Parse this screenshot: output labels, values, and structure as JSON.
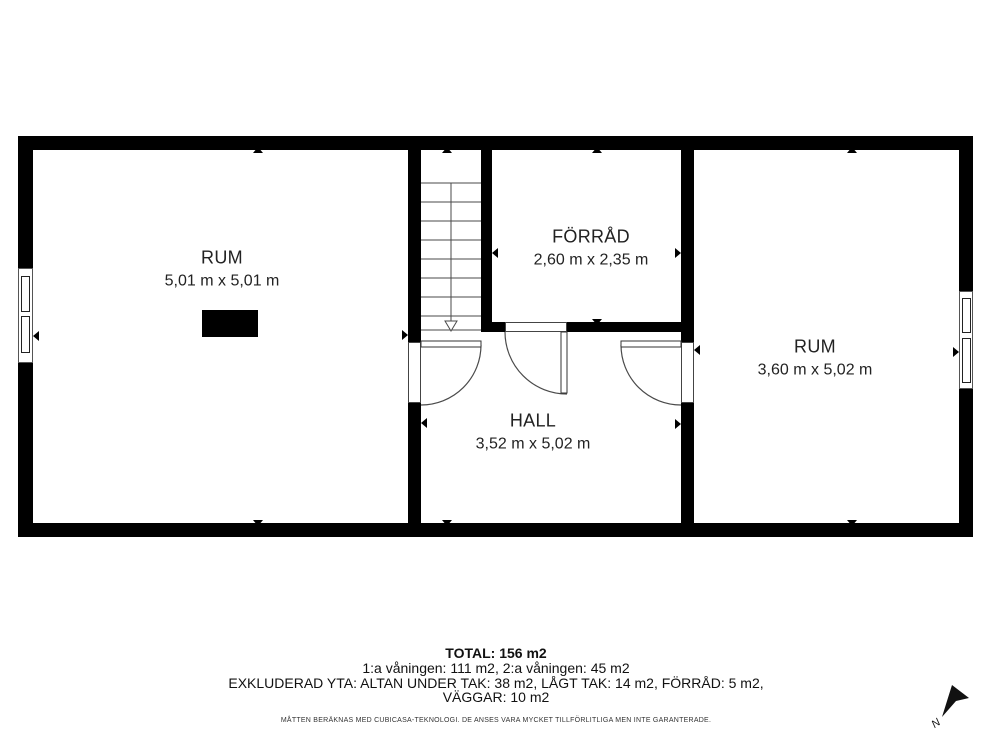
{
  "floorplan": {
    "rooms": [
      {
        "name": "RUM",
        "dimensions": "5,01 m x 5,01 m"
      },
      {
        "name": "FÖRRÅD",
        "dimensions": "2,60 m x 2,35 m"
      },
      {
        "name": "HALL",
        "dimensions": "3,52 m x 5,02 m"
      },
      {
        "name": "RUM",
        "dimensions": "3,60 m x 5,02 m"
      }
    ],
    "compass_label": "N"
  },
  "summary": {
    "total": "TOTAL: 156 m2",
    "floors": "1:a våningen: 111 m2, 2:a våningen: 45 m2",
    "excluded": "EXKLUDERAD YTA: ALTAN UNDER TAK: 38 m2, LÅGT TAK: 14 m2, FÖRRÅD: 5 m2,",
    "excluded2": "VÄGGAR: 10 m2",
    "disclaimer": "MÅTTEN BERÄKNAS MED CUBICASA-TEKNOLOGI. DE ANSES VARA MYCKET TILLFÖRLITLIGA MEN INTE GARANTERADE."
  },
  "colors": {
    "wall": "#000000",
    "background": "#ffffff",
    "line": "#4a4a4a"
  }
}
